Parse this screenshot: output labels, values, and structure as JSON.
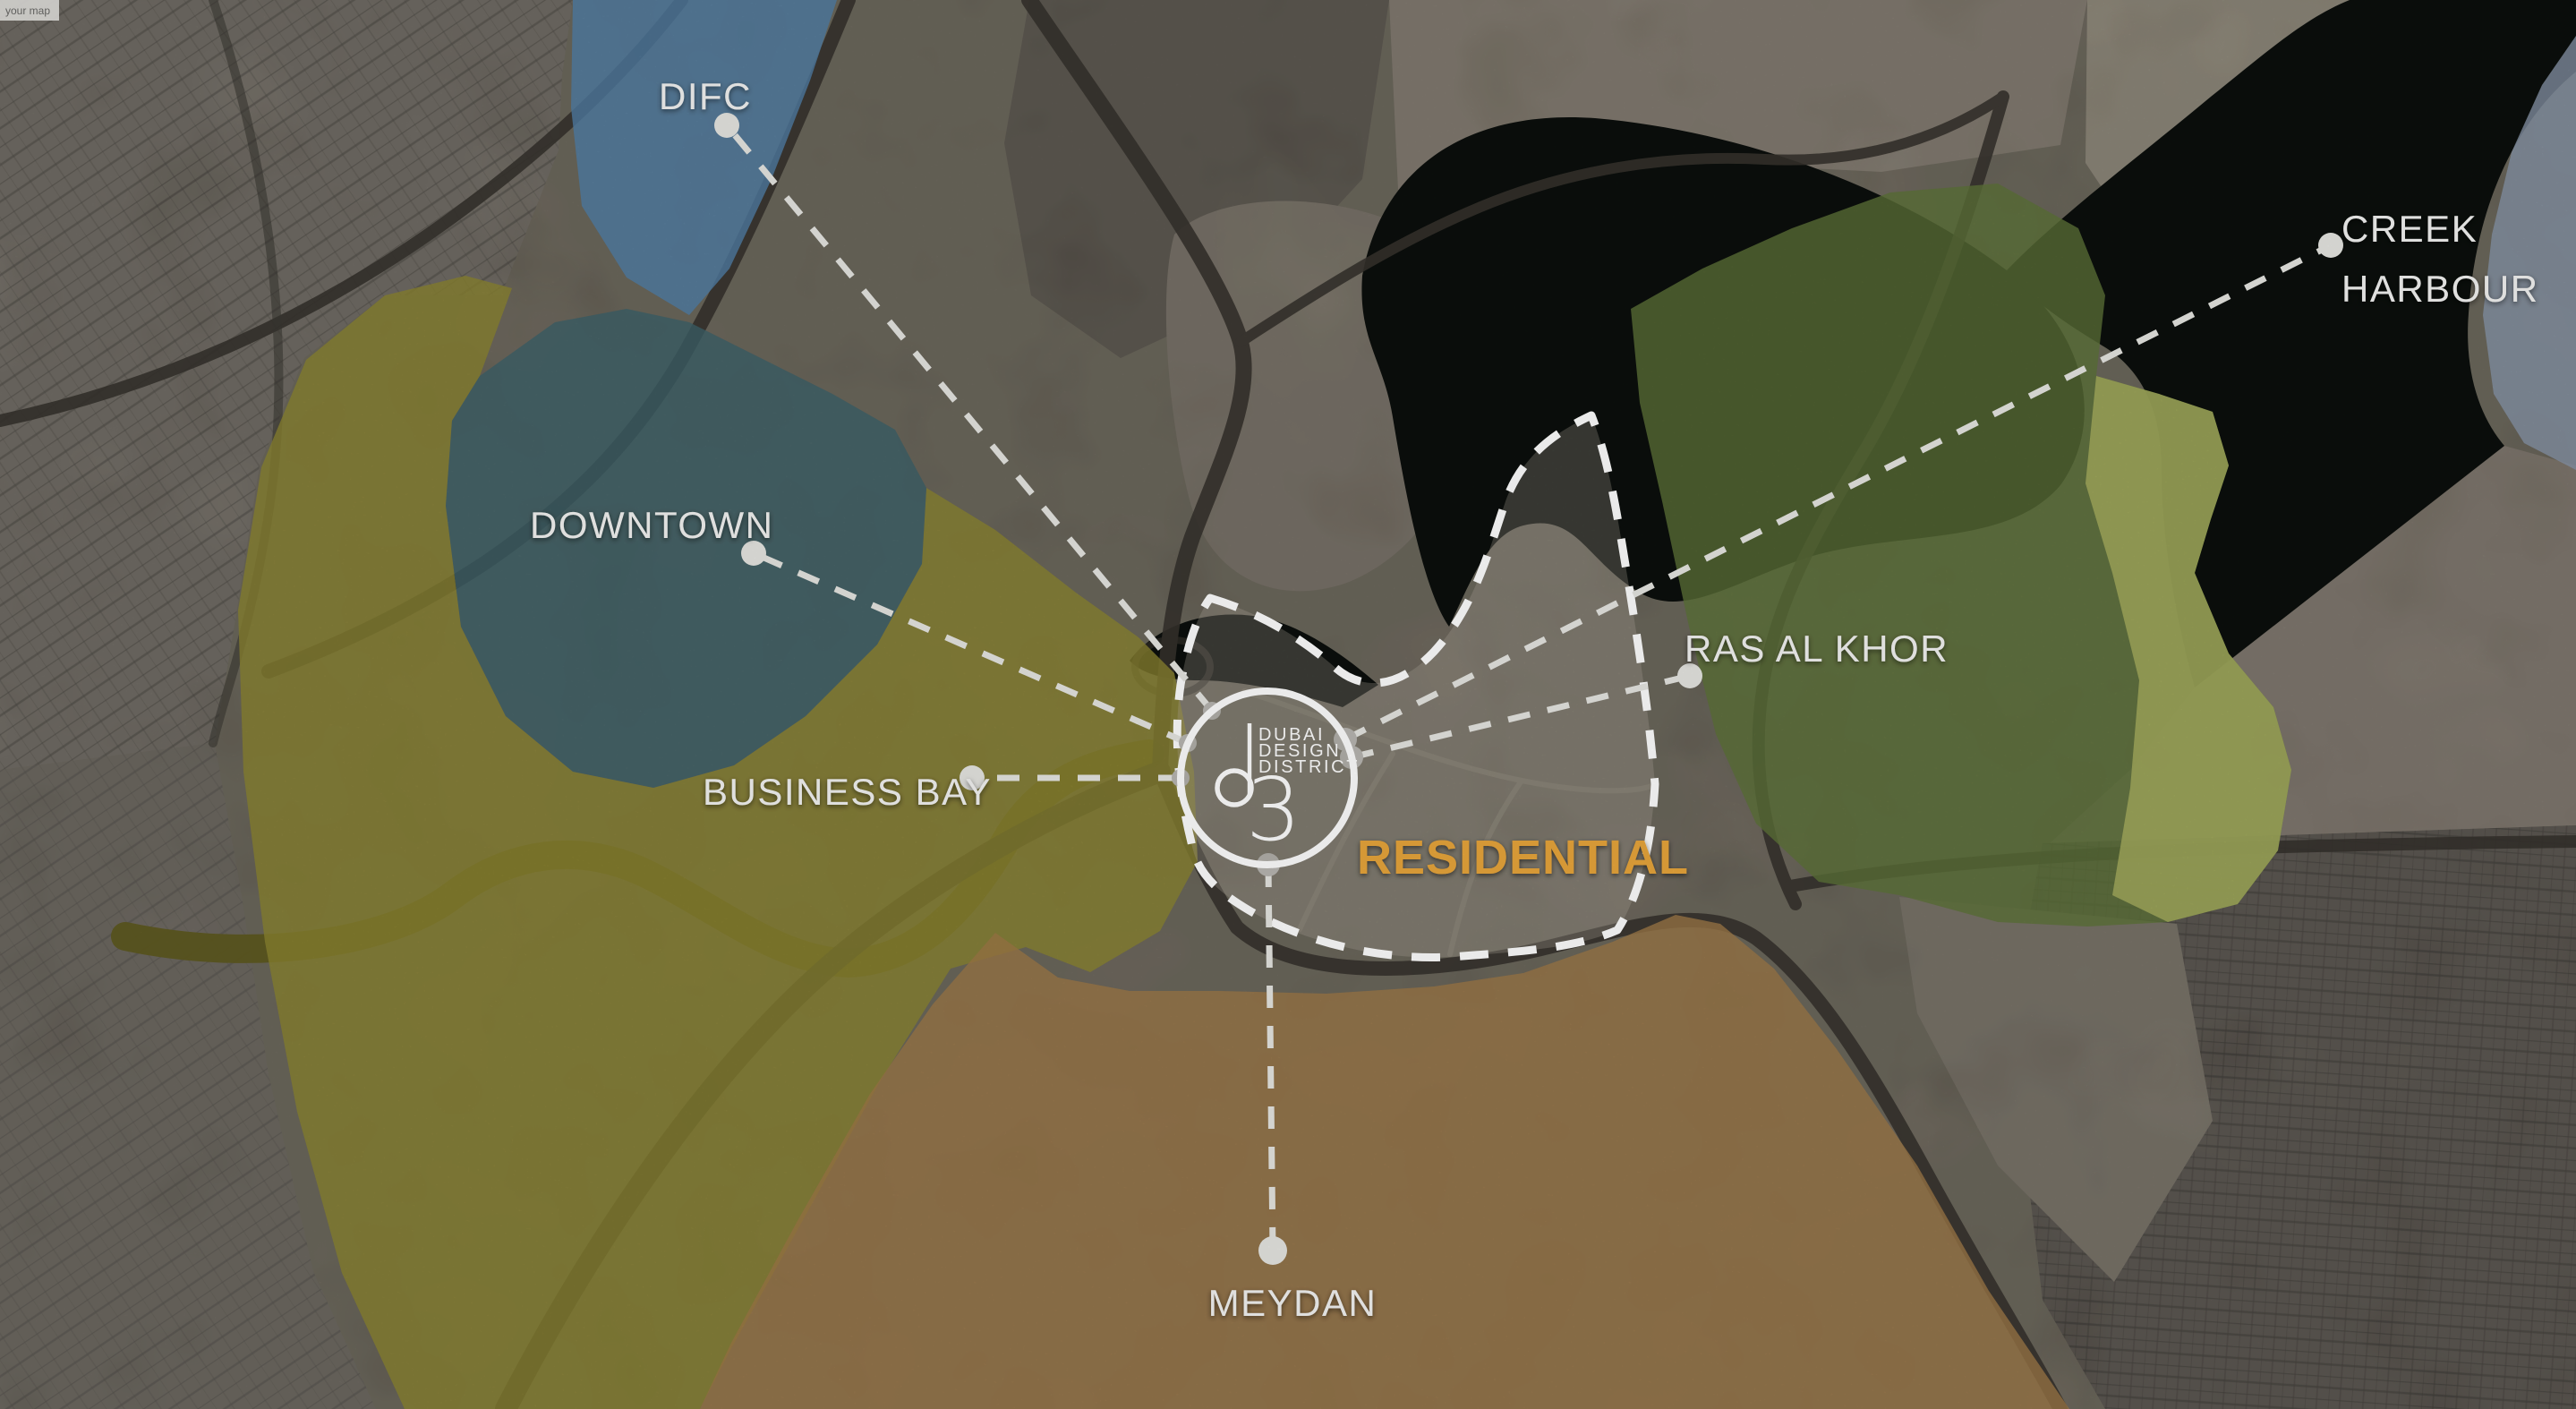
{
  "watermark": {
    "text": "your map"
  },
  "districts": {
    "difc": "DIFC",
    "downtown": "DOWNTOWN",
    "business_bay": "BUSINESS BAY",
    "creek_harbour_line1": "CREEK",
    "creek_harbour_line2": "HARBOUR",
    "ras_al_khor": "RAS AL KHOR",
    "meydan": "MEYDAN",
    "residential": "RESIDENTIAL"
  },
  "logo": {
    "name_line1": "DUBAI",
    "name_line2": "DESIGN",
    "name_line3": "DISTRICT",
    "numeral": "3"
  },
  "colors": {
    "difc_region": "#5180A8",
    "downtown_region": "#3D6169",
    "business_bay_region": "#8C8431",
    "ras_al_khor_region": "#5E7338",
    "ras_al_khor_bright": "#A9B05F",
    "meydan_region": "#9E7847",
    "creek_harbour_region": "#8795A7",
    "water": "#0B0F0C",
    "residential_label": "#E9A63B",
    "label_text": "#F4F4F2",
    "callout_line": "#E6E6E2",
    "boundary_line": "#FFFFFF"
  }
}
